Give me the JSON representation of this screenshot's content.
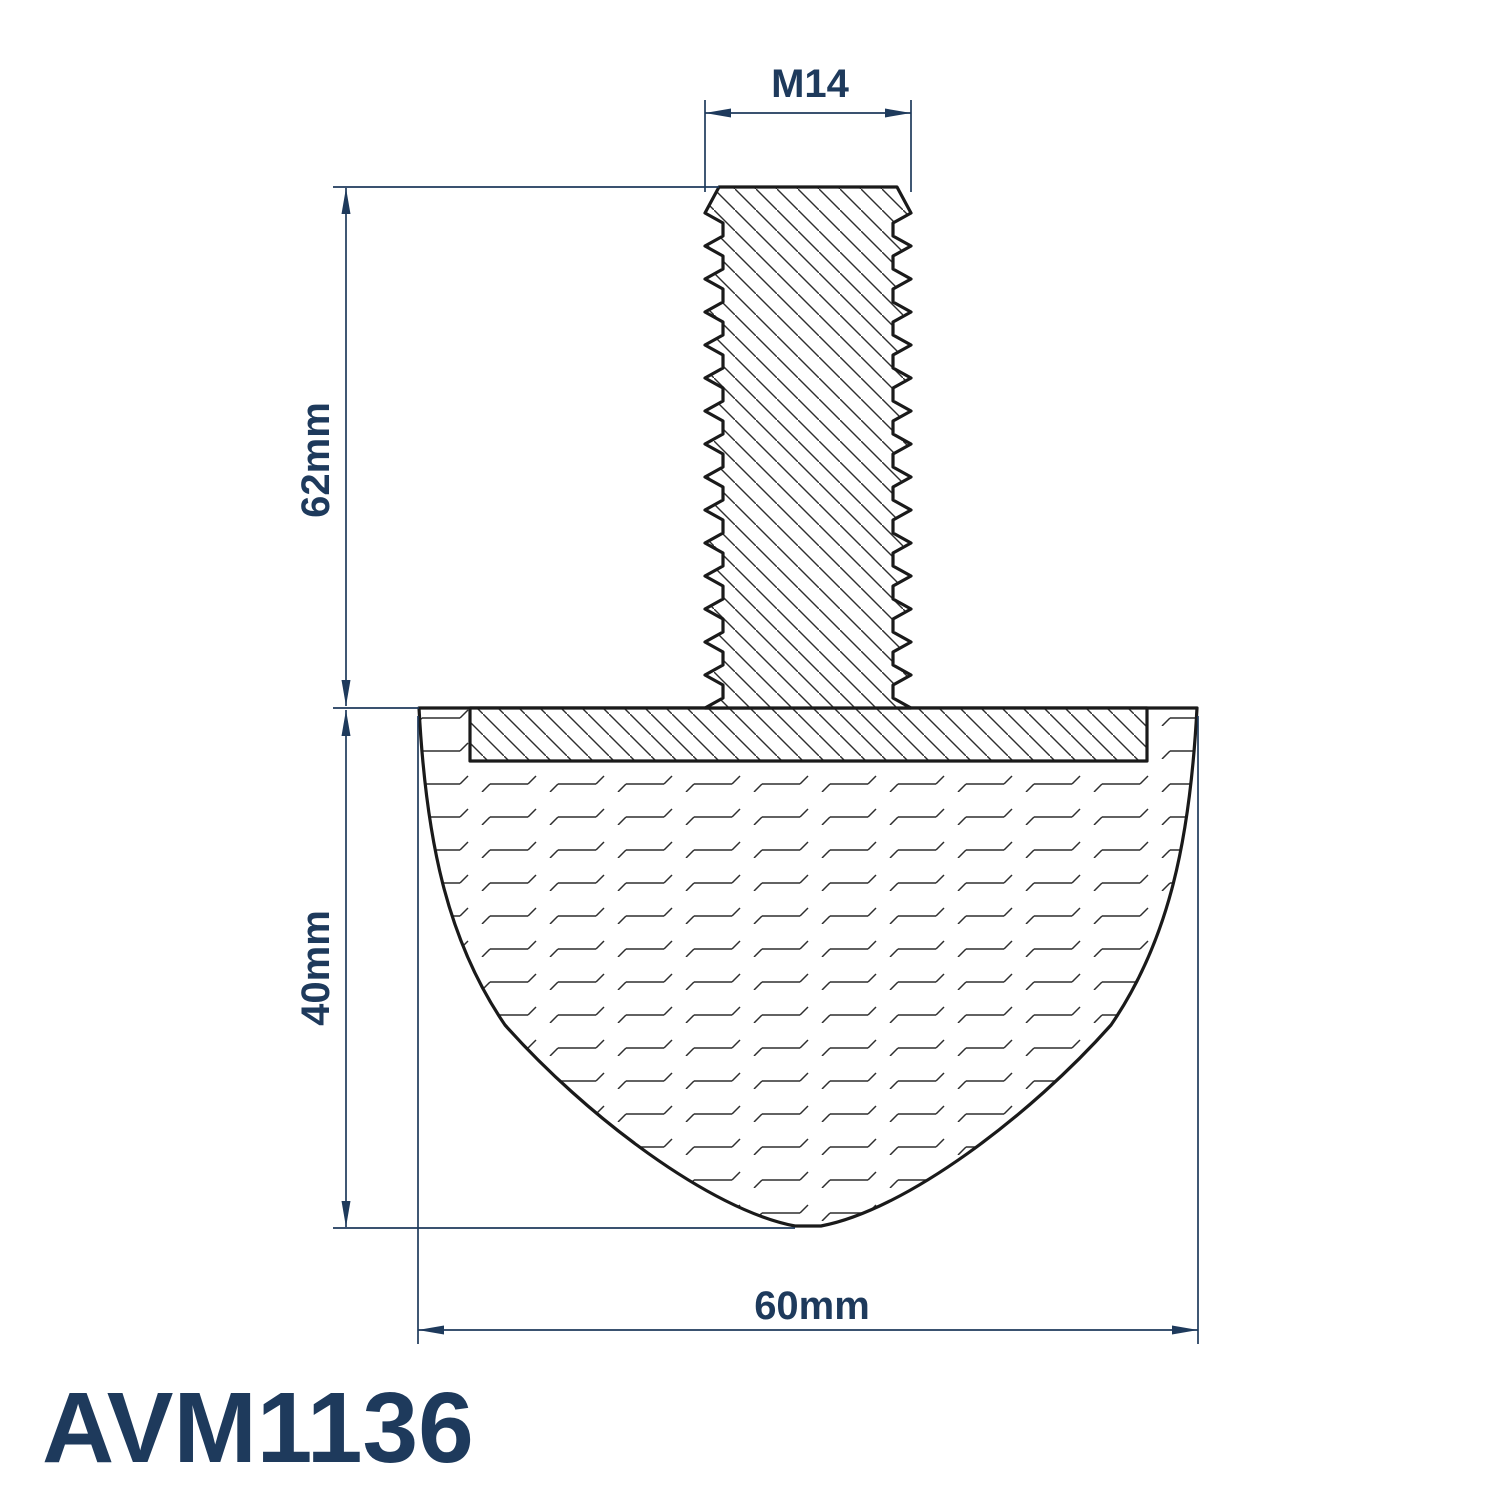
{
  "drawing": {
    "part_number": "AVM1136",
    "labels": {
      "thread_size": "M14",
      "stud_length": "62mm",
      "body_height": "40mm",
      "body_width": "60mm"
    },
    "colors": {
      "dimension": "#1e3a5c",
      "outline": "#1a1a1a",
      "hatch": "#2e2e2e",
      "background": "#ffffff"
    }
  }
}
